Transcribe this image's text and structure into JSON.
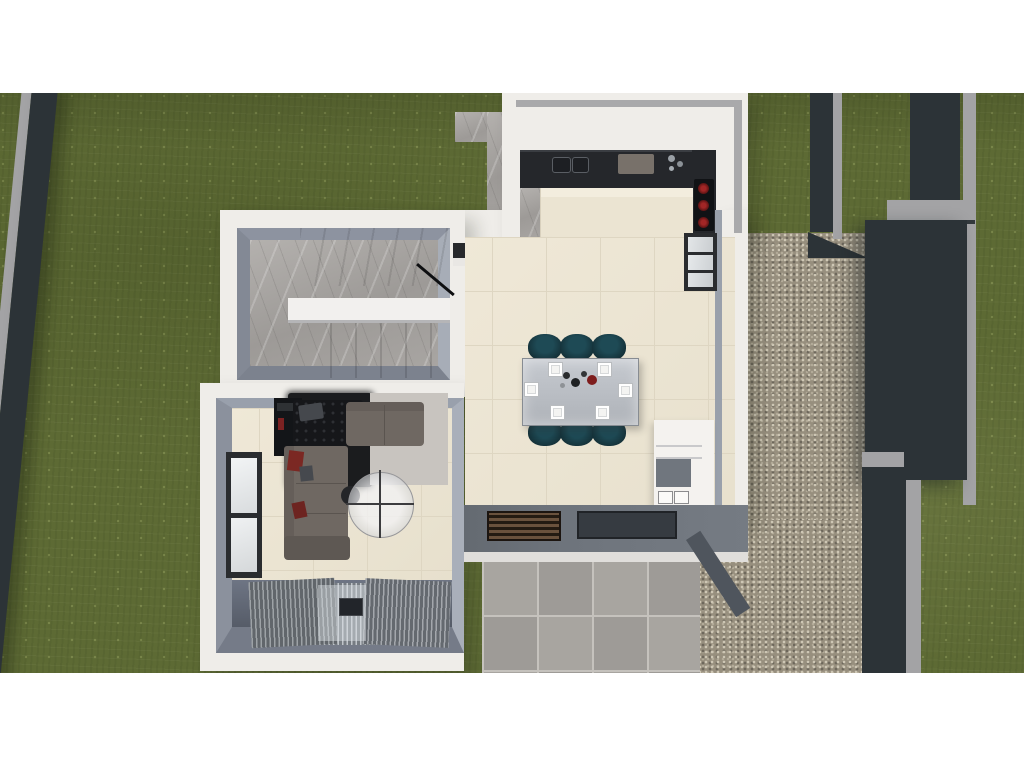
{
  "scene": {
    "description": "Aerial top-down 3D architectural render of a modern single-storey house floor plan with garden, gravel side yard and patio",
    "view": "top-down",
    "letterbox": "white bands above and below the render",
    "environment": {
      "lawn": "olive green grass surrounding the house",
      "boundary_fence_left": "diagonal dark charcoal wall with light grey cap",
      "boundary_walls_right": "dark charcoal garden walls with grey caps",
      "gravel_court": "speckled gravel side yard on the right",
      "stone_path": "grey stone walkway strip beside the kitchen block",
      "patio": "square grey tile terrace at the bottom"
    },
    "rooms": [
      {
        "name": "kitchen",
        "features": [
          "dark L-shaped countertop",
          "double sink",
          "induction cooktop with 3 red burners",
          "cream stone island",
          "grey marble floor strip",
          "white parapet roof edge",
          "three-pane window on right wall"
        ]
      },
      {
        "name": "dining-area",
        "features": [
          "cream tile floor",
          "steel rectangular dining table",
          "6 dark teal chairs",
          "6 white square place settings",
          "centerpiece decor",
          "white wall shelving unit",
          "south wall with slatted and dark roof openings"
        ]
      },
      {
        "name": "staircase",
        "features": [
          "grey marble U-shaped stair",
          "white mid landing wall",
          "black handrail",
          "upper flight diagonal treads",
          "lower flight treads"
        ]
      },
      {
        "name": "living-room",
        "features": [
          "L-shaped grey-brown sofa",
          "black tufted leather daybed",
          "tv cabinet with red accent",
          "dark charcoal rug",
          "light grey rug",
          "round glass coffee table",
          "dark pouf",
          "two-pane window on left wall",
          "silver louvered deck blinds"
        ]
      }
    ],
    "counts": {
      "dining_chairs": 6,
      "place_settings": 6,
      "cooktop_burners": 3,
      "window_panes_right": 3,
      "window_panes_left": 2
    }
  },
  "theme": {
    "colors": {
      "grass-base": "#5d6a34",
      "fence-dark": "#2c3337",
      "fence-cap": "#a3a3a5",
      "gravel-base": "#978f7e",
      "gravel-dark": "#6e685c",
      "gravel-light": "#cfc8b6",
      "gravel-mid": "#b3ab99",
      "wall-white": "#efede9",
      "parapet": "#a9a9ab",
      "wall-face": "#8a909c",
      "wall-face-light": "#abb1bb",
      "wall-face-dark": "#747a87",
      "floor-line": "#ded6c2",
      "counter": "#25272b",
      "cooktop": "#101215",
      "burner": "#a12626",
      "burner-dark": "#521111",
      "steel": "#bcc0c5",
      "teal": "#16343c",
      "teal-light": "#1e4a55",
      "sofa": "#6f6862",
      "sofa-dark": "#5e5853",
      "bench": "#16171a",
      "rug-dark": "#1b1c1e",
      "rug-light": "#c8c4bf",
      "glass": "#eef0f2",
      "frame": "#2a2c2f",
      "deck": "#6e7584",
      "louver-a": "#c0c5ca",
      "louver-b": "#767c82",
      "patio-tile": "#a8a5a0",
      "patio-grout": "#c5c2bd",
      "slat-brown": "#6a523d",
      "slat-brown-dark": "#241b12",
      "opening": "#363b41",
      "south-face": "#e0dedb"
    }
  }
}
